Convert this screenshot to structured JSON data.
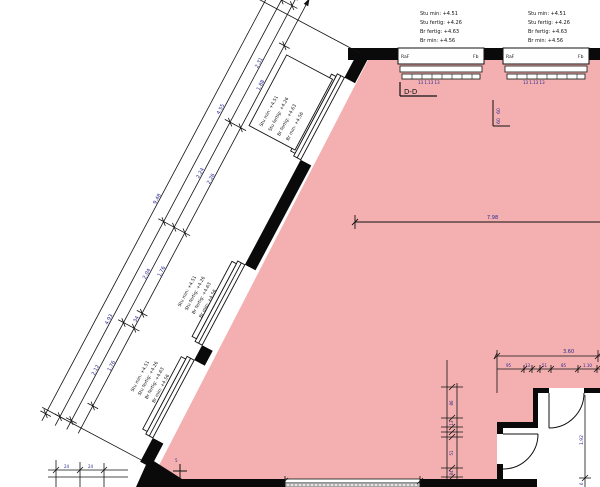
{
  "colors": {
    "room_fill": "#f4b0b0",
    "wall": "#0a0a0a",
    "dim_text": "#26268e"
  },
  "header_blocks": [
    {
      "lines": [
        "Stu min:  +4.51",
        "Stu fertig:  +4.26",
        "Br fertig:  +4.63",
        "Br min:  +4.56"
      ]
    },
    {
      "lines": [
        "Stu min:  +4.51",
        "Stu fertig:  +4.26",
        "Br fertig:  +4.63",
        "Br min:  +4.56"
      ]
    }
  ],
  "top_windows": [
    {
      "left_label": "RaF",
      "right_label": "Fb",
      "under_dims": "13   1.13   13"
    },
    {
      "left_label": "RaF",
      "right_label": "Fb",
      "under_dims": "13   1.13   13"
    }
  ],
  "window_notes": [
    {
      "lines": [
        "Stu min:  +4.51",
        "Stu fertig:  +4.26",
        "Br fertig:  +4.63",
        "Br min:  +4.56"
      ]
    },
    {
      "lines": [
        "Stu min:  +4.51",
        "Stu fertig:  +4.26",
        "Br fertig:  +4.63",
        "Br min:  +4.56"
      ]
    },
    {
      "lines": [
        "Stu min:  +4.51",
        "Stu fertig:  +4.26",
        "Br fertig:  +4.63",
        "Br min:  +4.56"
      ]
    }
  ],
  "section_marker": {
    "label": "D-D"
  },
  "column_marker": {
    "a": "60",
    "b": "60"
  },
  "main_dim": {
    "total": "7.98"
  },
  "right_block": {
    "h_total": "3.60",
    "h_segs": [
      "95",
      "13",
      "51",
      "85",
      "1.10"
    ],
    "v_left": [
      "86",
      "13",
      "51",
      "84"
    ],
    "v_right": "1.92",
    "v_right_end": "6"
  },
  "diag_chains": {
    "c1": [
      "1.88",
      "2.26",
      "1.76",
      "34",
      "1.76"
    ],
    "c2": [
      "2.31",
      "2.24",
      "2.04",
      "2.12"
    ],
    "c3": [
      "4.55",
      "4.93"
    ],
    "total": "9.48"
  },
  "bottom_left_dims": {
    "a": "24",
    "b": "24"
  },
  "misc": {
    "cross_label": "5"
  }
}
